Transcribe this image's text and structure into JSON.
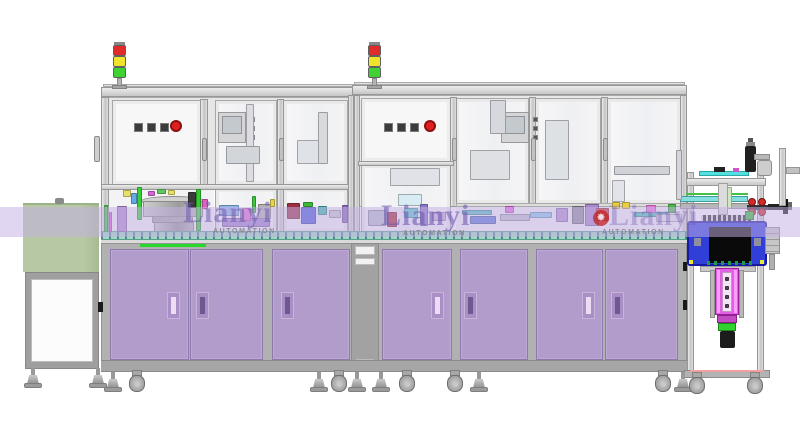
{
  "scene": {
    "description": "front-view CAD rendering of a two-module automated assembly line with purple base cabinets, glass enclosures, signal towers, bowl feeder, infeed table and outfeed press stand"
  },
  "watermark": {
    "brand": "Lianyi",
    "subtitle": "AUTOMATION"
  },
  "watermark_instances": [
    {
      "x": 183,
      "y": 198,
      "opacity": 0.55,
      "logo": false,
      "sub_dx": 30,
      "sub_dy": 30
    },
    {
      "x": 381,
      "y": 201,
      "opacity": 0.6,
      "logo": false,
      "sub_dx": 22,
      "sub_dy": 29
    },
    {
      "x": 609,
      "y": 201,
      "opacity": 0.36,
      "logo": true,
      "sub_dx": -7,
      "sub_dy": 28
    }
  ],
  "colors": {
    "background": "#ffffff",
    "cabinet_purple": "#b19ccb",
    "cabinet_purple_border": "#8d79ab",
    "aluminum": "#d9d9d9",
    "base_gray": "#b1b1b1",
    "glass": "#f2f2f5",
    "infeed_table_green": "#b7c8a4",
    "conveyor_teal": "#9fd6c4",
    "accent_green": "#28d828",
    "tower_red": "#e12a2a",
    "tower_yellow": "#efe32b",
    "tower_green": "#3ed233",
    "emergency_button_red": "#df2020",
    "fixture_blue": "#2f3fd8",
    "actuator_magenta": "#e160e1",
    "watermark_purple": "#6f5cb0",
    "watermark_band": "rgba(196,176,228,0.52)",
    "watermark_logo_red": "#c22222"
  },
  "signal_towers": {
    "xs": [
      113,
      368
    ],
    "light_colors": [
      "#e12a2a",
      "#efe32b",
      "#3ed233"
    ]
  },
  "control_panels": [
    {
      "square_button_xs": [
        134,
        147,
        160
      ],
      "button_y": 123,
      "emergency_x": 170,
      "emergency_y": 120
    },
    {
      "square_button_xs": [
        384,
        397,
        410
      ],
      "button_y": 123,
      "emergency_x": 424,
      "emergency_y": 120
    }
  ],
  "hmi_panels": [
    {
      "x": 218,
      "y": 112,
      "button_x": 250
    },
    {
      "x": 501,
      "y": 112,
      "button_x": 533
    }
  ],
  "upper_door_handle_xs": [
    202,
    279,
    452,
    531,
    603
  ],
  "cabinet_doors": [
    {
      "x": 110,
      "w": 79,
      "hx": 167,
      "slot": "light"
    },
    {
      "x": 190,
      "w": 73,
      "hx": 196,
      "slot": "dark"
    },
    {
      "x": 272,
      "w": 78,
      "hx": 281,
      "slot": "dark"
    },
    {
      "x": 382,
      "w": 70,
      "hx": 431,
      "slot": "light"
    },
    {
      "x": 460,
      "w": 68,
      "hx": 464,
      "slot": "dark"
    },
    {
      "x": 536,
      "w": 67,
      "hx": 582,
      "slot": "light"
    },
    {
      "x": 605,
      "w": 73,
      "hx": 611,
      "slot": "dark"
    }
  ],
  "machine_feet_xs": [
    104,
    310,
    348,
    372,
    470,
    674
  ],
  "machine_caster_xs": [
    128,
    330,
    398,
    446,
    654
  ],
  "stand_feet_xs": [
    24,
    89
  ],
  "outfeed_caster_xs": [
    688,
    746
  ],
  "machinery_blocks": [
    {
      "x": 104,
      "y": 205,
      "w": 4,
      "h": 27,
      "c": "#3cc83c"
    },
    {
      "x": 109,
      "y": 212,
      "w": 3,
      "h": 20,
      "c": "#e06ae0"
    },
    {
      "x": 117,
      "y": 206,
      "w": 10,
      "h": 26,
      "c": "#b08cd0"
    },
    {
      "x": 123,
      "y": 190,
      "w": 8,
      "h": 7,
      "c": "#e8e06a"
    },
    {
      "x": 131,
      "y": 193,
      "w": 6,
      "h": 11,
      "c": "#64aae8"
    },
    {
      "x": 137,
      "y": 187,
      "w": 5,
      "h": 33,
      "c": "#38d038"
    },
    {
      "x": 188,
      "y": 192,
      "w": 8,
      "h": 16,
      "c": "#3a3a3a"
    },
    {
      "x": 196,
      "y": 189,
      "w": 5,
      "h": 42,
      "c": "#32cc32"
    },
    {
      "x": 202,
      "y": 199,
      "w": 6,
      "h": 10,
      "c": "#e060c0"
    },
    {
      "x": 148,
      "y": 191,
      "w": 7,
      "h": 5,
      "c": "#d565d5"
    },
    {
      "x": 157,
      "y": 189,
      "w": 9,
      "h": 5,
      "c": "#5fc85f"
    },
    {
      "x": 168,
      "y": 190,
      "w": 7,
      "h": 5,
      "c": "#e8e060"
    },
    {
      "x": 219,
      "y": 205,
      "w": 20,
      "h": 11,
      "c": "#8cb6e6"
    },
    {
      "x": 222,
      "y": 218,
      "w": 48,
      "h": 9,
      "c": "#a284cc"
    },
    {
      "x": 242,
      "y": 208,
      "w": 9,
      "h": 13,
      "c": "#e072d2"
    },
    {
      "x": 252,
      "y": 196,
      "w": 4,
      "h": 17,
      "c": "#3ec43e"
    },
    {
      "x": 258,
      "y": 204,
      "w": 13,
      "h": 15,
      "c": "#b2b2b2"
    },
    {
      "x": 270,
      "y": 199,
      "w": 5,
      "h": 8,
      "c": "#e8d44a"
    },
    {
      "x": 287,
      "y": 203,
      "w": 13,
      "h": 16,
      "c": "#993344"
    },
    {
      "x": 301,
      "y": 207,
      "w": 15,
      "h": 17,
      "c": "#4c5ad8"
    },
    {
      "x": 303,
      "y": 202,
      "w": 10,
      "h": 5,
      "c": "#3cb83c"
    },
    {
      "x": 318,
      "y": 206,
      "w": 9,
      "h": 9,
      "c": "#38b8a8"
    },
    {
      "x": 329,
      "y": 210,
      "w": 12,
      "h": 8,
      "c": "#c8c8cc"
    },
    {
      "x": 342,
      "y": 205,
      "w": 6,
      "h": 18,
      "c": "#8868b8"
    },
    {
      "x": 368,
      "y": 210,
      "w": 18,
      "h": 16,
      "c": "#b8bcc8"
    },
    {
      "x": 387,
      "y": 212,
      "w": 10,
      "h": 15,
      "c": "#a82830"
    },
    {
      "x": 398,
      "y": 194,
      "w": 24,
      "h": 12,
      "c": "#d8ecf4"
    },
    {
      "x": 404,
      "y": 208,
      "w": 14,
      "h": 10,
      "c": "#58c8c8"
    },
    {
      "x": 420,
      "y": 204,
      "w": 8,
      "h": 22,
      "c": "#8878c8"
    },
    {
      "x": 432,
      "y": 212,
      "w": 14,
      "h": 9,
      "c": "#c8a8e0"
    },
    {
      "x": 462,
      "y": 210,
      "w": 30,
      "h": 5,
      "c": "#50c0c0"
    },
    {
      "x": 470,
      "y": 216,
      "w": 26,
      "h": 8,
      "c": "#5878d8"
    },
    {
      "x": 500,
      "y": 214,
      "w": 30,
      "h": 7,
      "c": "#c0c0c8"
    },
    {
      "x": 505,
      "y": 206,
      "w": 9,
      "h": 7,
      "c": "#e06ae0"
    },
    {
      "x": 530,
      "y": 212,
      "w": 22,
      "h": 6,
      "c": "#88c8e8"
    },
    {
      "x": 556,
      "y": 208,
      "w": 12,
      "h": 14,
      "c": "#b090d0"
    },
    {
      "x": 572,
      "y": 206,
      "w": 12,
      "h": 18,
      "c": "#8c8c94"
    },
    {
      "x": 585,
      "y": 204,
      "w": 14,
      "h": 22,
      "c": "#a888cc"
    },
    {
      "x": 596,
      "y": 208,
      "w": 13,
      "h": 13,
      "c": "#cc3434"
    },
    {
      "x": 612,
      "y": 202,
      "w": 8,
      "h": 7,
      "c": "#e8d040"
    },
    {
      "x": 622,
      "y": 202,
      "w": 8,
      "h": 7,
      "c": "#e8d040"
    },
    {
      "x": 634,
      "y": 212,
      "w": 34,
      "h": 5,
      "c": "#48c4b4"
    },
    {
      "x": 646,
      "y": 205,
      "w": 10,
      "h": 8,
      "c": "#e878d8"
    },
    {
      "x": 656,
      "y": 214,
      "w": 26,
      "h": 8,
      "c": "#e4e4e8"
    },
    {
      "x": 668,
      "y": 204,
      "w": 8,
      "h": 9,
      "c": "#48b848"
    },
    {
      "x": 246,
      "y": 104,
      "w": 8,
      "h": 78,
      "c": "#dcdce2"
    },
    {
      "x": 226,
      "y": 146,
      "w": 34,
      "h": 18,
      "c": "#d2d6da"
    },
    {
      "x": 297,
      "y": 140,
      "w": 26,
      "h": 24,
      "c": "#dfe2e6"
    },
    {
      "x": 318,
      "y": 112,
      "w": 10,
      "h": 52,
      "c": "#d8dade"
    },
    {
      "x": 490,
      "y": 100,
      "w": 16,
      "h": 34,
      "c": "#d6d8de"
    },
    {
      "x": 470,
      "y": 150,
      "w": 40,
      "h": 30,
      "c": "#dee0e4"
    },
    {
      "x": 545,
      "y": 120,
      "w": 24,
      "h": 60,
      "c": "#dde0e4"
    },
    {
      "x": 614,
      "y": 166,
      "w": 56,
      "h": 9,
      "c": "#d0d2d8"
    },
    {
      "x": 612,
      "y": 180,
      "w": 13,
      "h": 22,
      "c": "#e2e4ea"
    },
    {
      "x": 676,
      "y": 150,
      "w": 6,
      "h": 50,
      "c": "#d4d6dc"
    },
    {
      "x": 390,
      "y": 168,
      "w": 50,
      "h": 18,
      "c": "#e0e2e8"
    },
    {
      "x": 718,
      "y": 183,
      "w": 10,
      "h": 32,
      "c": "#dcdcdc"
    },
    {
      "x": 727,
      "y": 187,
      "w": 5,
      "h": 22,
      "c": "#cfe6c0"
    },
    {
      "x": 725,
      "y": 277,
      "w": 4,
      "h": 4,
      "c": "#5a3a5a"
    },
    {
      "x": 725,
      "y": 286,
      "w": 4,
      "h": 4,
      "c": "#5a3a5a"
    },
    {
      "x": 725,
      "y": 295,
      "w": 4,
      "h": 4,
      "c": "#5a3a5a"
    },
    {
      "x": 725,
      "y": 304,
      "w": 4,
      "h": 4,
      "c": "#5a3a5a"
    }
  ]
}
